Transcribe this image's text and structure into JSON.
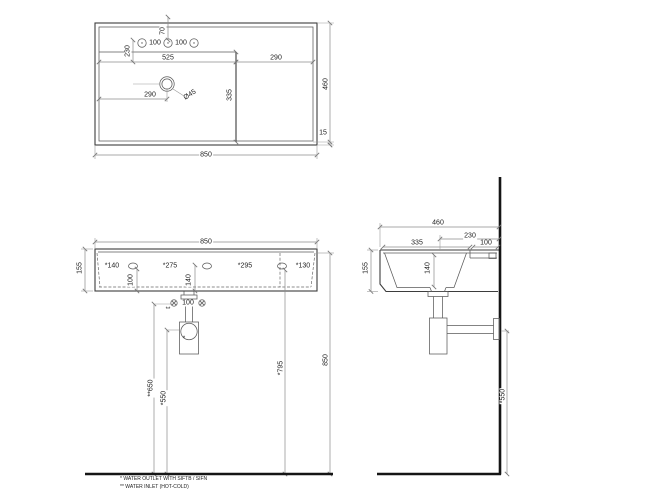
{
  "views": {
    "top": {
      "label_70": "70",
      "label_100_left": "100",
      "label_100_right": "100",
      "label_230": "230",
      "label_525": "525",
      "label_290_shelf": "290",
      "label_290_drain": "290",
      "label_335": "335",
      "label_diam": "Ø45",
      "label_460": "460",
      "label_15": "15",
      "label_850": "850"
    },
    "front": {
      "label_850_top": "850",
      "label_155": "155",
      "label_140": "*140",
      "label_275": "*275",
      "label_295": "*295",
      "label_130": "*130",
      "label_100_vert": "100",
      "label_140_vert": "140",
      "label_100_inlets": "100",
      "label_inlet_mark": "**",
      "label_outlet_mark": "*",
      "label_650": "**650",
      "label_550": "*550",
      "label_795": "*795",
      "label_850_right": "850"
    },
    "side": {
      "label_460": "460",
      "label_230": "230",
      "label_335": "335",
      "label_100": "100",
      "label_155": "155",
      "label_140": "140",
      "label_550": "*550"
    },
    "notes": {
      "outlet": "* WATER OUTLET WITH SIFTB / SIFN",
      "inlet": "** WATER INLET  (HOT-COLD)"
    }
  }
}
